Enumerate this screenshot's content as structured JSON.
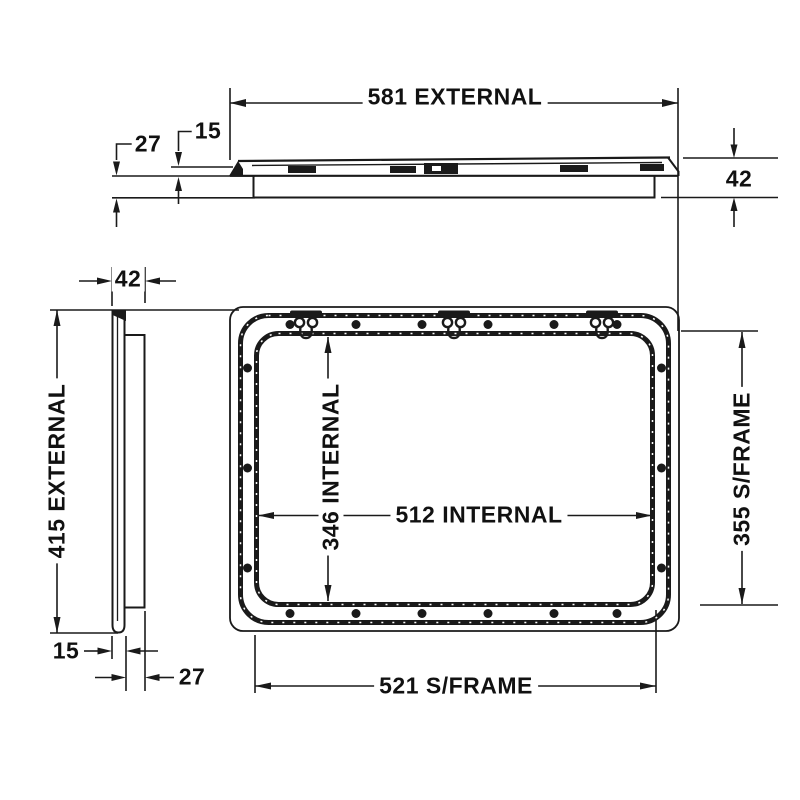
{
  "drawing": {
    "type": "technical-drawing",
    "views": {
      "top_profile": "hatch lid horizontal cross-section",
      "side_profile": "hatch lid vertical cross-section",
      "front_frame": "hatch frame with rounded corners, screw holes and hinges"
    },
    "labels": {
      "external_width": "581 EXTERNAL",
      "lid_thickness_top": "15",
      "flange_depth_top": "27",
      "profile_height_right": "42",
      "profile_width_side": "42",
      "external_height": "415 EXTERNAL",
      "internal_height": "346 INTERNAL",
      "internal_width": "512 INTERNAL",
      "subframe_height": "355 S/FRAME",
      "subframe_width": "521 S/FRAME",
      "lid_thickness_side": "15",
      "flange_depth_side": "27"
    },
    "colors": {
      "line": "#1a1a1a",
      "background": "#ffffff"
    }
  }
}
